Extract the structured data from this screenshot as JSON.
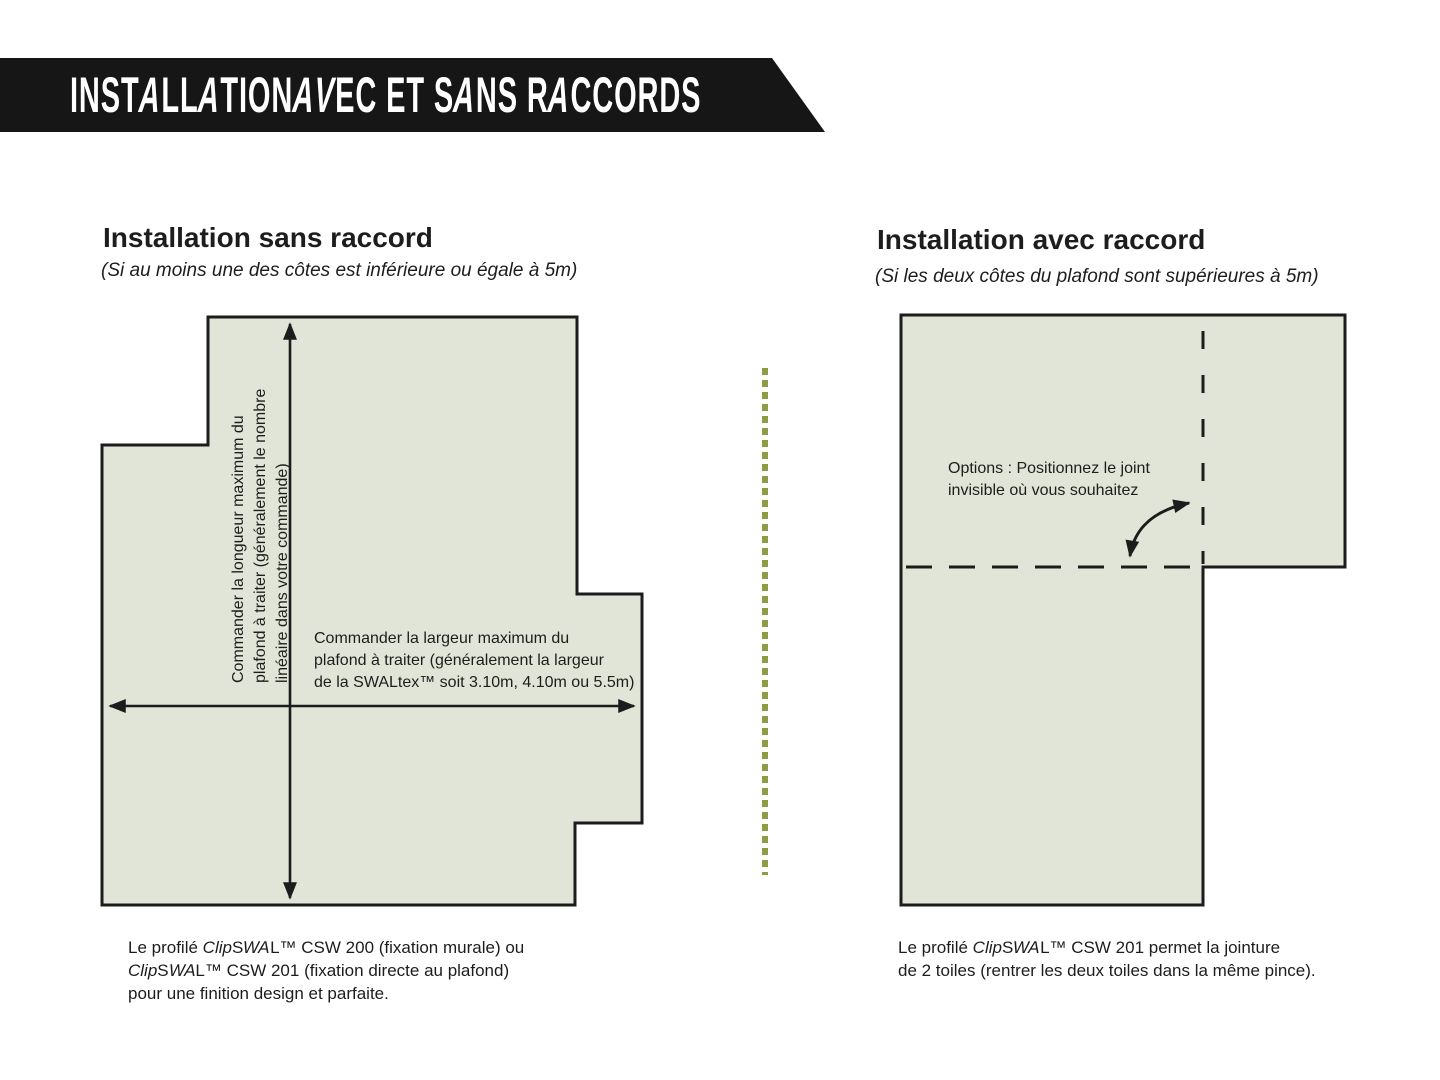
{
  "colors": {
    "page_bg": "#ffffff",
    "banner_bg": "#161616",
    "banner_text": "#ffffff",
    "shape_fill": "#e1e5d7",
    "line": "#1c1c1c",
    "separator": "#8e9d44",
    "text": "#1d1d1d"
  },
  "banner": {
    "title": "INSTALLATION AVEC ET SANS RACCORDS"
  },
  "panels": {
    "left": {
      "title": "Installation sans raccord",
      "subtitle": "(Si au moins une des côtes est inférieure ou égale à 5m)",
      "diagram": {
        "vertical_label": "Commander la longueur maximum du\nplafond à traiter (généralement le nombre\nlinéaire dans votre commande)",
        "horizontal_label": "Commander la largeur maximum du\nplafond à traiter (généralement la largeur\nde la SWALtex™ soit 3.10m, 4.10m ou 5.5m)"
      },
      "caption_lines": [
        [
          {
            "t": "Le profilé ",
            "s": "n"
          },
          {
            "t": "Clip",
            "s": "i"
          },
          {
            "t": "S",
            "s": "n"
          },
          {
            "t": "WA",
            "s": "sl"
          },
          {
            "t": "L",
            "s": "n"
          },
          {
            "t": "™ CSW 200 (fixation murale) ou",
            "s": "n"
          }
        ],
        [
          {
            "t": "Clip",
            "s": "i"
          },
          {
            "t": "S",
            "s": "n"
          },
          {
            "t": "WA",
            "s": "sl"
          },
          {
            "t": "L",
            "s": "n"
          },
          {
            "t": "™ CSW 201 (fixation directe au plafond)",
            "s": "n"
          }
        ],
        [
          {
            "t": "pour une finition design et parfaite.",
            "s": "n"
          }
        ]
      ]
    },
    "right": {
      "title": "Installation avec raccord",
      "subtitle": "(Si les deux côtes du plafond sont supérieures à 5m)",
      "diagram": {
        "options_label": "Options : Positionnez le joint\ninvisible où vous souhaitez"
      },
      "caption_lines": [
        [
          {
            "t": "Le profilé ",
            "s": "n"
          },
          {
            "t": "Clip",
            "s": "i"
          },
          {
            "t": "S",
            "s": "n"
          },
          {
            "t": "WA",
            "s": "sl"
          },
          {
            "t": "L",
            "s": "n"
          },
          {
            "t": "™ CSW 201 permet la jointure",
            "s": "n"
          }
        ],
        [
          {
            "t": "de 2 toiles (rentrer les deux toiles dans la même pince).",
            "s": "n"
          }
        ]
      ]
    }
  }
}
